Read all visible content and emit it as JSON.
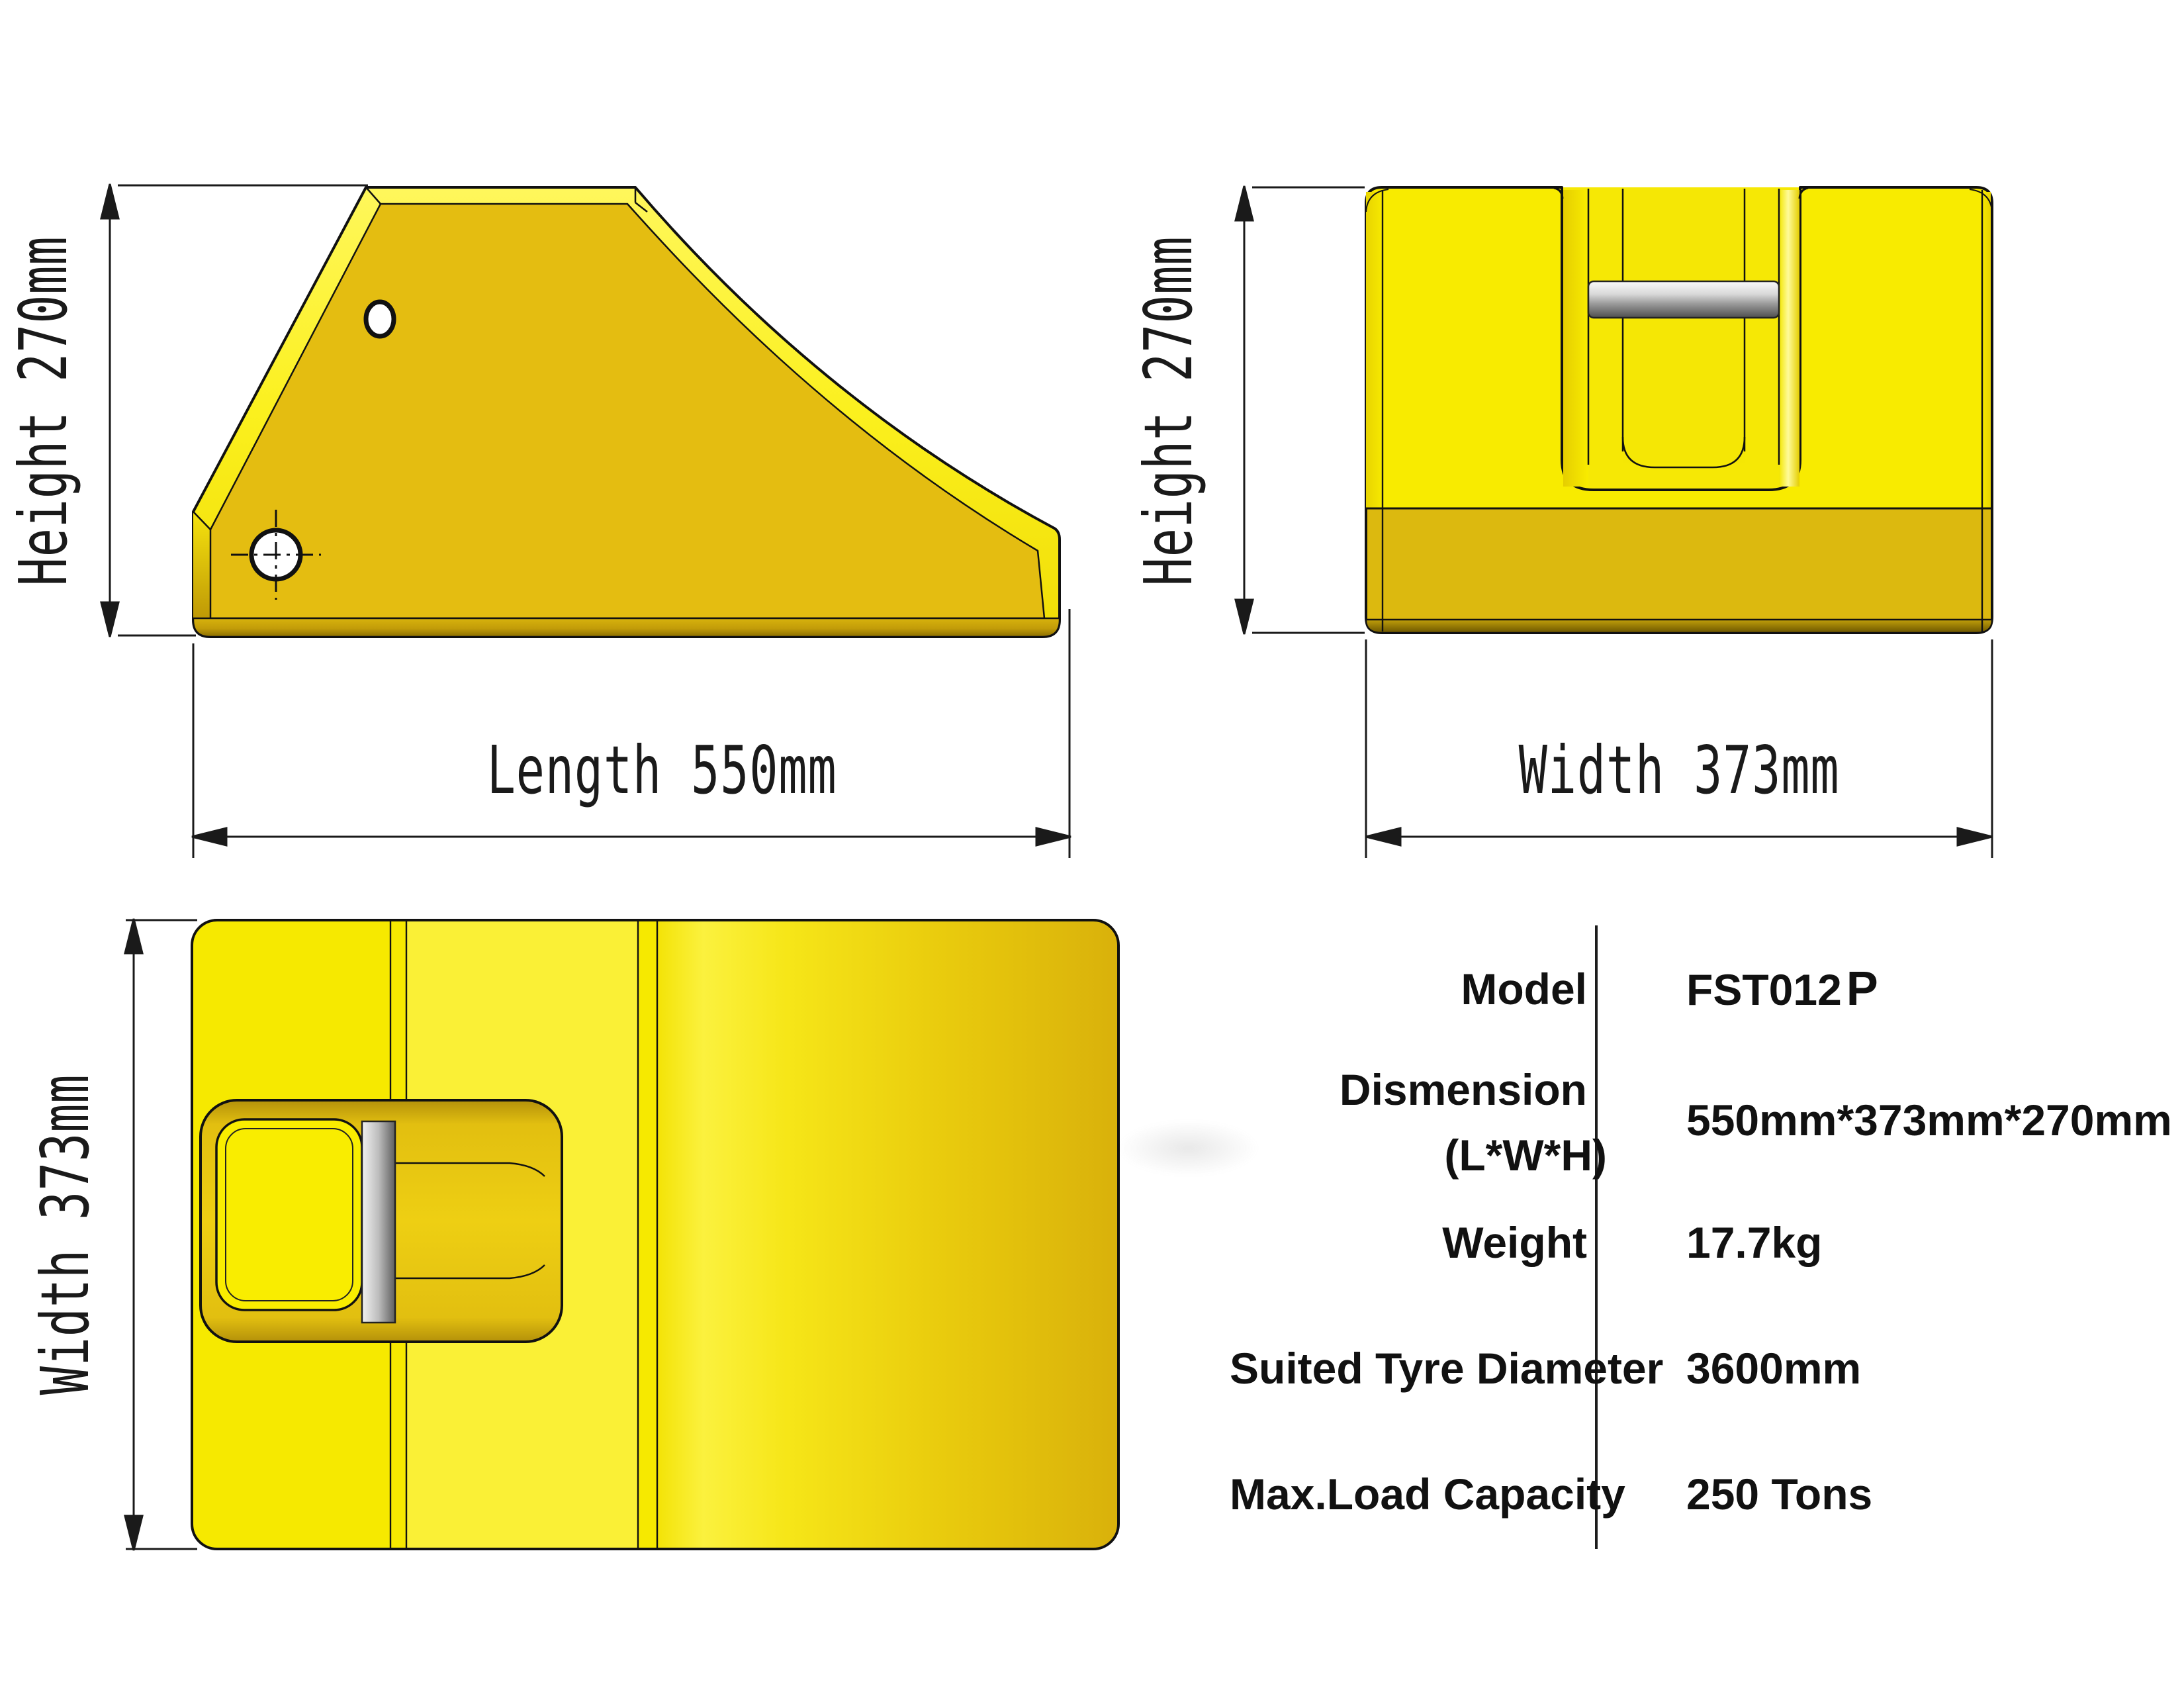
{
  "drawing_title": "Wheel chock three-view technical drawing",
  "dimensions": {
    "side_height": "Height 270mm",
    "side_length": "Length 550mm",
    "front_height": "Height 270mm",
    "front_width": "Width 373mm",
    "top_width": "Width 373mm"
  },
  "spec_table": {
    "rows": [
      {
        "label": "Model",
        "value": "FST012",
        "value_suffix": "P"
      },
      {
        "label": "Dismension",
        "label2": "(L*W*H)",
        "value": "550mm*373mm*270mm"
      },
      {
        "label": "Weight",
        "value": "17.7kg"
      },
      {
        "label": "Suited Tyre Diameter",
        "value": "3600mm"
      },
      {
        "label": "Max.Load Capacity",
        "value": "250 Tons"
      }
    ]
  },
  "colors": {
    "background": "#FFFFFF",
    "body_bright_yellow": "#F8EB00",
    "body_gold_face": "#E4BD11",
    "bevel_highlight": "#FCF243",
    "base_band": "#DCB90F",
    "base_band_shadow": "#6E5800",
    "handle_gray_light": "#F2F2F2",
    "handle_gray_dark": "#4E4E4E",
    "outline": "#111111",
    "dimension_line": "#1A1A1A",
    "table_text": "#111111"
  }
}
